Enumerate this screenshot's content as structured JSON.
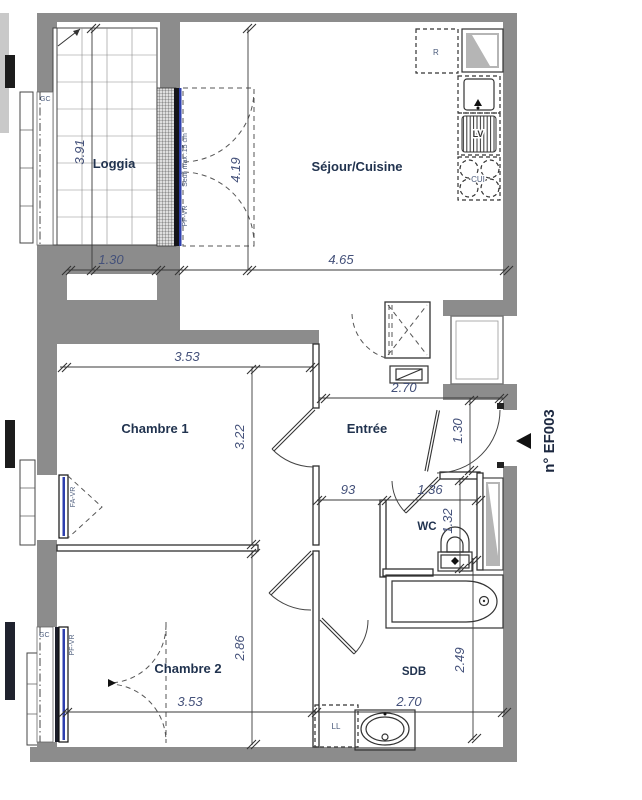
{
  "unit": {
    "number": "n° EF003"
  },
  "rooms": {
    "loggia": {
      "label": "Loggia",
      "width": "1.30",
      "height": "3.91"
    },
    "sejour": {
      "label": "Séjour/Cuisine",
      "width": "4.65",
      "height": "4.19"
    },
    "chambre1": {
      "label": "Chambre 1",
      "width": "3.53",
      "height": "3.22"
    },
    "entree": {
      "label": "Entrée",
      "width": "2.70",
      "entry_depth": "1.30",
      "corridor_width": "93"
    },
    "wc": {
      "label": "WC",
      "width": "1.36",
      "height": "1.32"
    },
    "sdb": {
      "label": "SDB",
      "width": "2.70",
      "height": "2.49"
    },
    "chambre2": {
      "label": "Chambre 2",
      "width": "3.53",
      "height": "2.86"
    }
  },
  "fixtures": {
    "fridge": "R",
    "dishwasher": "LV",
    "cooktop": "CUI",
    "washing_machine": "LL"
  },
  "windows": {
    "gc": "GC",
    "pf_vr": "PF-VR",
    "fa_vr": "FA-VR",
    "seuil": "Seuil max :15 cm"
  },
  "colors": {
    "wall": "#8c8c8c",
    "room_label": "#21334f",
    "dimension_text": "#44517a",
    "glazing_blue": "#2e3fae"
  }
}
